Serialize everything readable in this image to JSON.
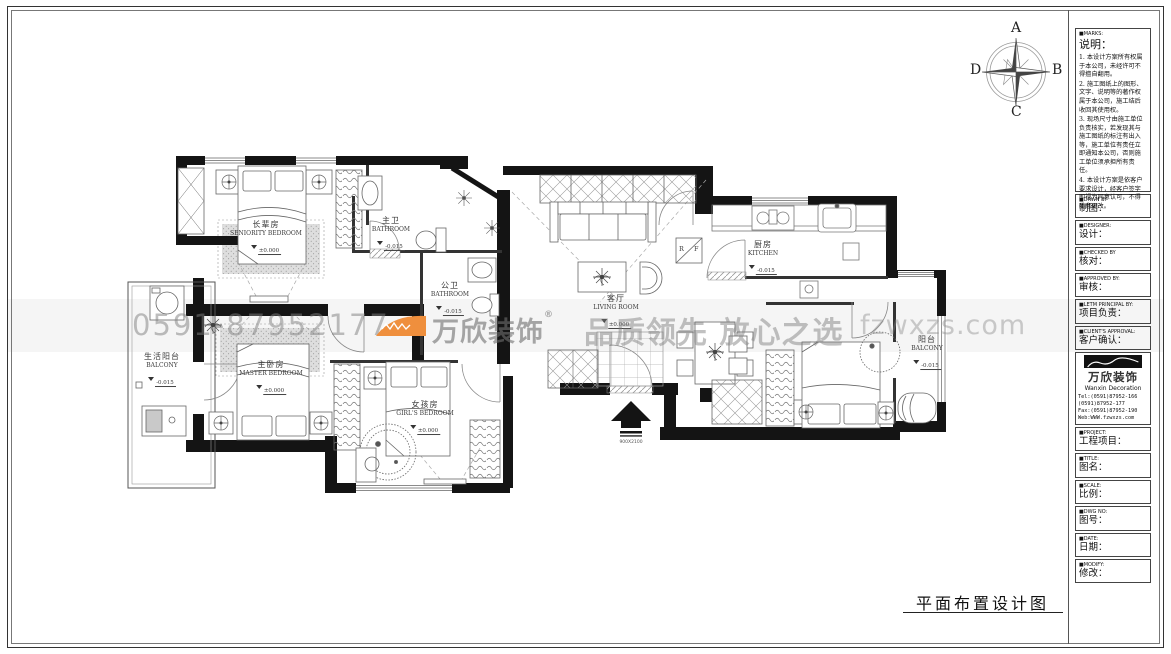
{
  "drawing_title": "平面布置设计图",
  "compass": {
    "top": "A",
    "right": "B",
    "bottom": "C",
    "left": "D"
  },
  "watermark": {
    "phone": "0591-87952177",
    "brand": "万欣装饰",
    "reg": "®",
    "slogan": "品质领先 放心之选",
    "website": "fzwxzs.com",
    "logo_color": "#ef8f3d"
  },
  "entry": {
    "label": "900X2100"
  },
  "appliances": {
    "fridge": "R F"
  },
  "rooms": {
    "seniority": {
      "cn": "长辈房",
      "en": "SENIORITY BEDROOM",
      "level": "±0.000"
    },
    "master_bath": {
      "cn": "主卫",
      "en": "BATHROOM",
      "level": "-0.015"
    },
    "public_bath": {
      "cn": "公卫",
      "en": "BATHROOM",
      "level": "-0.015"
    },
    "living": {
      "cn": "客厅",
      "en": "LIVING ROOM",
      "level": "±0.000"
    },
    "kitchen": {
      "cn": "厨房",
      "en": "KITCHEN",
      "level": "-0.015"
    },
    "life_balcony": {
      "cn": "生活阳台",
      "en": "BALCONY",
      "level": "-0.015"
    },
    "master": {
      "cn": "主卧房",
      "en": "MASTER BEDROOM",
      "level": "±0.000"
    },
    "girl": {
      "cn": "女孩房",
      "en": "GIRL'S BEDROOM",
      "level": "±0.000"
    },
    "balcony": {
      "cn": "阳台",
      "en": "BALCONY",
      "level": "-0.015"
    }
  },
  "titleblock": {
    "marks": {
      "en": "■MARKS:",
      "cn": "说明：",
      "notes": [
        "1. 本设计方案所有权属于本公司，未经许可不得擅自翻用。",
        "2. 施工图纸上的图形、文字、说明等的著作权属于本公司，施工结后收回其使用权。",
        "3. 现场尺寸由施工单位负责核实，若发现其与施工图纸的标注有出入等，施工单位有责任立即通知本公司，否则施工单位须承担所有责任。",
        "4. 本设计方案是依客户要求设计，经客户签字即视为同意认可，不得随意更改。"
      ]
    },
    "rows": [
      {
        "en": "■DRWN BY",
        "cn": "制图："
      },
      {
        "en": "■DESIGNER:",
        "cn": "设计："
      },
      {
        "en": "■CHECKED BY",
        "cn": "核对："
      },
      {
        "en": "■APPROVED BY:",
        "cn": "审核："
      },
      {
        "en": "■LETM PRINCIPAL BY:",
        "cn": "项目负责："
      },
      {
        "en": "■CLIENT'S APPROVAL:",
        "cn": "客户确认："
      }
    ],
    "brand": {
      "logo_cn": "万欣装饰",
      "logo_en": "Wanxin Decoration",
      "tel1": "Tel:(0591)87952-166",
      "tel2": "    (0591)87952-177",
      "fax": "Fax:(0591)87952-190",
      "web": "Web:WWW.fzwxzs.com"
    },
    "rows2": [
      {
        "en": "■PROJECT:",
        "cn": "工程项目："
      },
      {
        "en": "■TITLE:",
        "cn": "图名："
      },
      {
        "en": "■SCALE:",
        "cn": "比例："
      },
      {
        "en": "■DWG NO:",
        "cn": "图号："
      },
      {
        "en": "■DATE:",
        "cn": "日期："
      },
      {
        "en": "■MODIFY:",
        "cn": "修改："
      }
    ]
  }
}
